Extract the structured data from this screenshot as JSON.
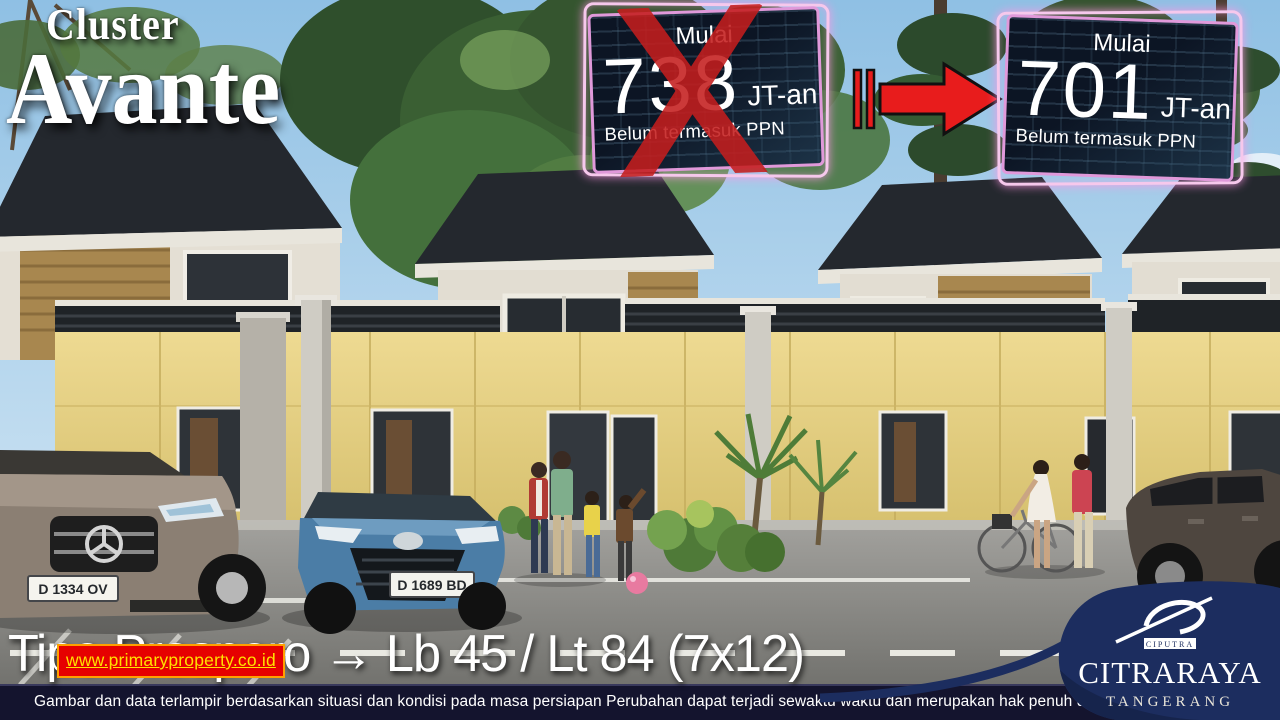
{
  "title": {
    "small": "Cluster",
    "big": "Avante"
  },
  "promo": {
    "old": {
      "label": "Mulai",
      "price": "738",
      "unit": "JT-an",
      "note": "Belum termasuk PPN"
    },
    "new": {
      "label": "Mulai",
      "price": "701",
      "unit": "JT-an",
      "note": "Belum termasuk PPN"
    }
  },
  "footer": {
    "type_line": "Tipe Prospero → Lb 45 / Lt 84 (7x12)",
    "watermark": "www.primaryproperty.co.id",
    "disclaimer": "Gambar dan data terlampir berdasarkan situasi dan kondisi pada masa persiapan Perubahan dapat terjadi sewaktu waktu dan merupakan hak penuh developer"
  },
  "logo": {
    "group": "CIPUTRA",
    "brand": "CITRARAYA",
    "city": "TANGERANG"
  },
  "scene": {
    "plate_left": "D 1334 OV",
    "plate_blue": "D 1689 BD"
  },
  "colors": {
    "accent_red": "#e01b1b",
    "neon_pink": "#f6c8ec",
    "neon_magenta": "#e099da",
    "badge_bg": "#0c1524",
    "navy": "#1c2d5f",
    "watermark_bg": "#e60000",
    "watermark_text": "#ffe000",
    "cream_wall": "#e6d386",
    "sky": "#9cc8e8"
  }
}
